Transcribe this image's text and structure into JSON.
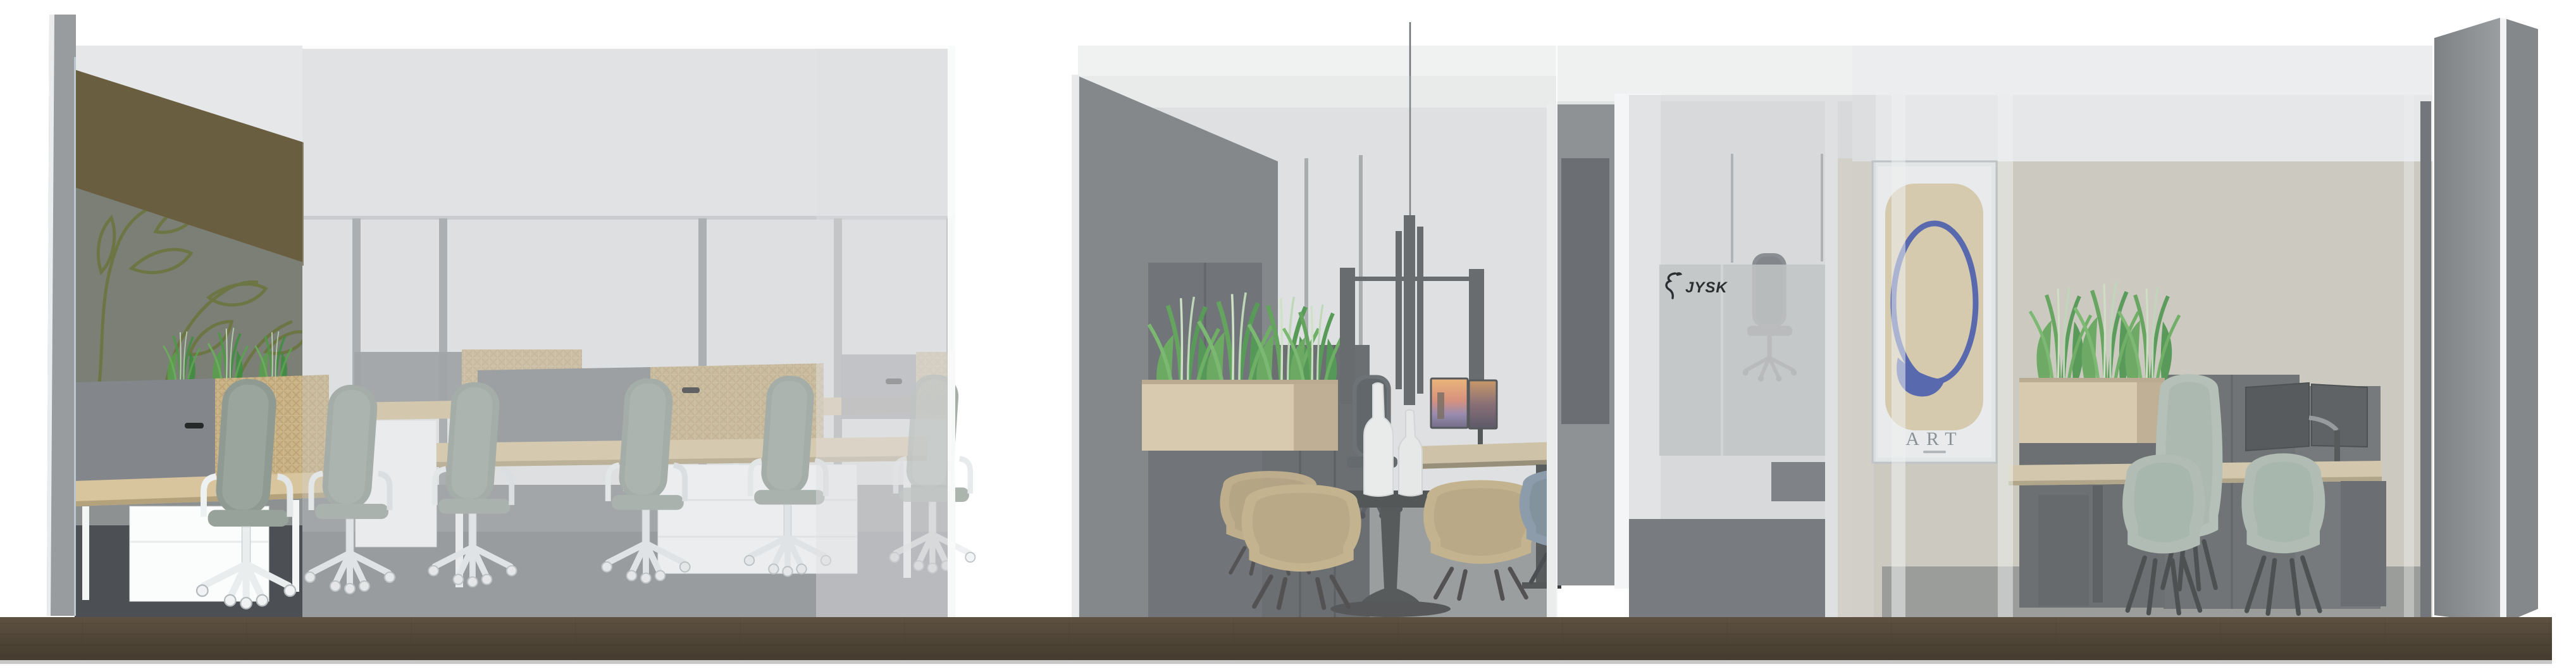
{
  "scene": {
    "description": "3D architectural section rendering of an office interior fit-out",
    "rooms": [
      {
        "name": "open-office",
        "objects": [
          "bench-desks",
          "task-chairs",
          "gray-privacy-screens",
          "rattan-privacy-screens",
          "white-mobile-pedestals",
          "leaf-mural-wall",
          "glass-facade",
          "desk-planter"
        ]
      },
      {
        "name": "meeting-room",
        "objects": [
          "round-pedestal-table",
          "tan-shell-armchairs",
          "slate-blue-chair",
          "bottle-vases",
          "pendant-lamp",
          "sit-stand-desk",
          "dual-monitors-sunset",
          "dark-cabinets",
          "wood-planter",
          "grass-plants",
          "dark-office-chair"
        ]
      },
      {
        "name": "corridor",
        "objects": [
          "frosted-glass-wall",
          "jysk-logo",
          "dark-office-chair",
          "dark-desk",
          "dark-carpet"
        ]
      },
      {
        "name": "private-office",
        "objects": [
          "art-poster",
          "beige-feature-wall",
          "wood-planter",
          "grass-plants",
          "sit-stand-desk",
          "dual-monitor-arm",
          "high-back-sage-chair",
          "sage-guest-chairs",
          "dark-cabinets",
          "open-door"
        ]
      }
    ]
  },
  "branding": {
    "jysk_label": "JYSK"
  },
  "poster": {
    "title": "ART"
  },
  "palette": {
    "background": "#ffffff",
    "cut_wall_gray": "#9a9da0",
    "glass_tint": "#ccd0d2",
    "back_wall_light": "#e3e4e5",
    "dark_wall": "#75787a",
    "olive_header_band": "#6a5e41",
    "mural_background": "#7b7f75",
    "mural_line_olive": "#6d7540",
    "oak_worktop": "#d8c59d",
    "rattan_screen": "#c9b284",
    "gray_screen": "#85888a",
    "sage_chair": "#9aa69d",
    "tan_chair": "#c3ac80",
    "slate_blue_chair": "#7e91a1",
    "beige_wall": "#ccc8bc",
    "poster_blob": "#d8c8a6",
    "poster_ring_blue": "#3d4fa4",
    "plant_green": "#57a14b",
    "carpet_gray": "#8f9293",
    "corridor_carpet_dark": "#3f444a",
    "floor_slab_brown": "#55493a",
    "door_gray": "#8a8d90",
    "logo_ink": "#2b2e30"
  }
}
